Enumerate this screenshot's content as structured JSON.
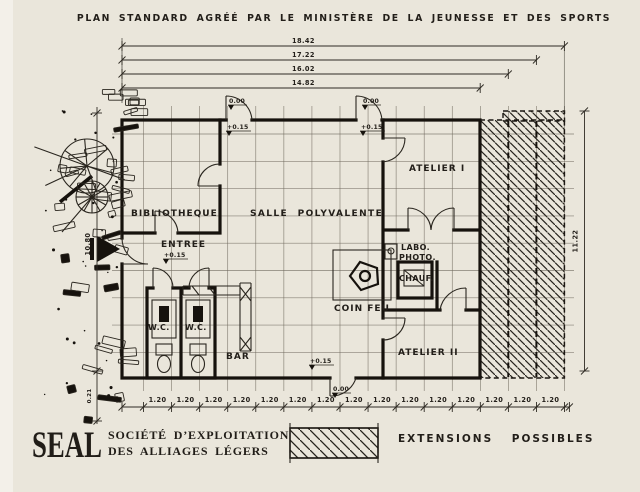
{
  "title": "PLAN STANDARD AGRÉÉ PAR LE MINISTÈRE DE LA JEUNESSE ET DES SPORTS",
  "colors": {
    "paper": "#eae6db",
    "ink": "#16120d",
    "grid_line": "#6e675c"
  },
  "plan": {
    "rooms": {
      "bibliotheque": "BIBLIOTHEQUE",
      "salle": "SALLE POLYVALENTE",
      "entree": "ENTREE",
      "wc_left": "W.C.",
      "wc_right": "W.C.",
      "bar": "BAR",
      "coin_feu": "COIN FEU",
      "labo_line1": "LABO.",
      "labo_line2": "PHOTO.",
      "chauf": "CHAUF.",
      "atelier1": "ATELIER I",
      "atelier2": "ATELIER II"
    },
    "levels": {
      "ground": "0.00",
      "raised": "+0.15"
    }
  },
  "dimensions": {
    "top": [
      "18.42",
      "17.22",
      "16.02",
      "14.82"
    ],
    "module": "1.20",
    "module_count": 15,
    "left_height": "10.80",
    "left_margin": "0.21",
    "right_height": "11.22"
  },
  "legend": {
    "logo": "SEAL",
    "company_line1": "SOCIÉTÉ D’EXPLOITATION",
    "company_line2": "DES ALLIAGES LÉGERS",
    "extensions": "EXTENSIONS POSSIBLES"
  }
}
